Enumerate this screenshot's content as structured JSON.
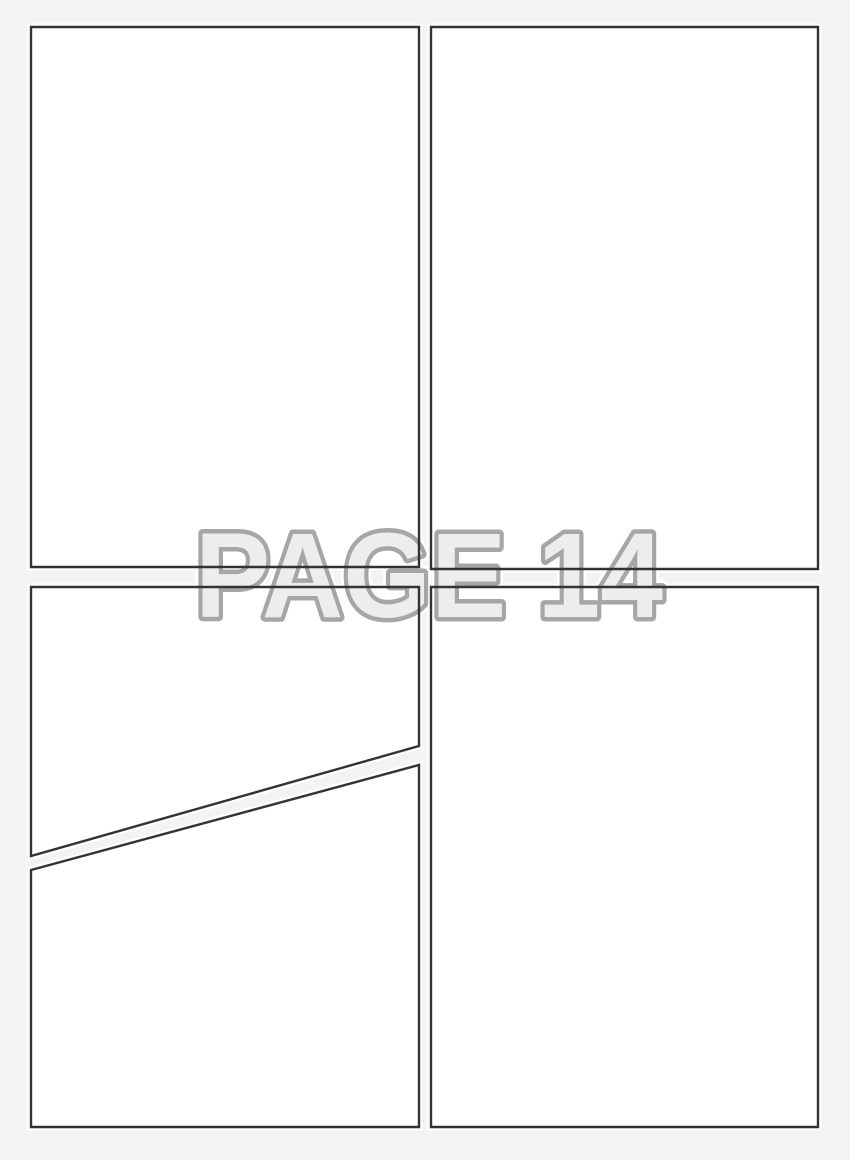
{
  "watermark": {
    "text": "PAGE 14",
    "page_number": "14"
  },
  "colors": {
    "page_background": "#f3f3f3",
    "panel_fill": "#ffffff",
    "panel_border": "#333333",
    "watermark_fill": "#ededed",
    "watermark_outline": "#a6a6a6",
    "watermark_halo": "#ffffff"
  },
  "panels": {
    "count": 5
  }
}
